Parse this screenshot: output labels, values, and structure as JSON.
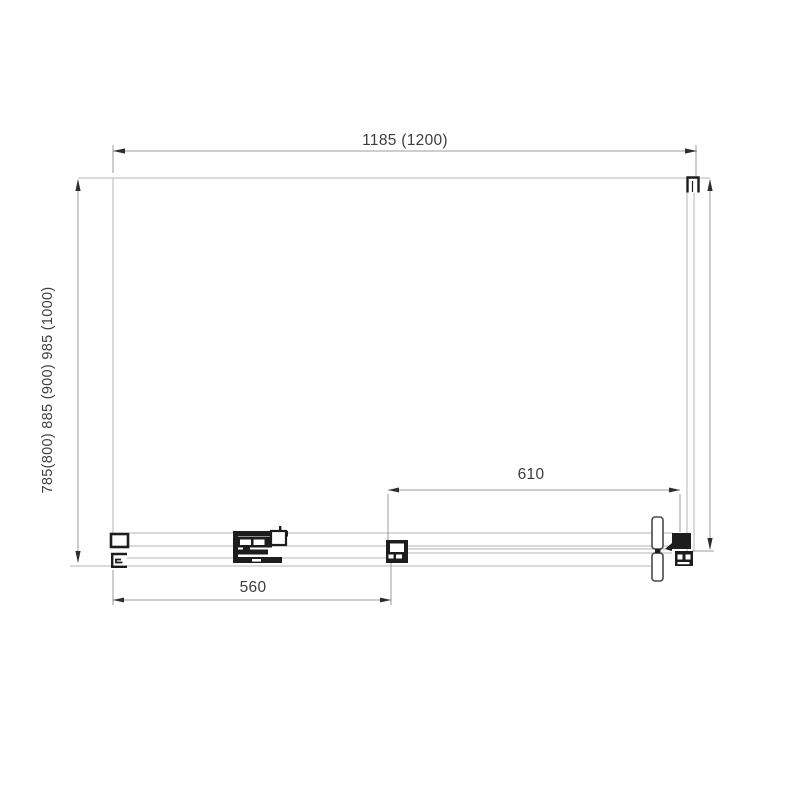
{
  "drawing": {
    "type": "shower-enclosure-top-view-technical-drawing",
    "dimensions": {
      "top_width": "1185 (1200)",
      "left_depth": "785(800) 885 (900) 985 (1000)",
      "opening_width": "610",
      "door_width": "560"
    }
  },
  "colors": {
    "background": "#ffffff",
    "outline": "#b4b4b4",
    "hardware": "#1d1d1d",
    "dimension_text": "#3d3d3d"
  }
}
